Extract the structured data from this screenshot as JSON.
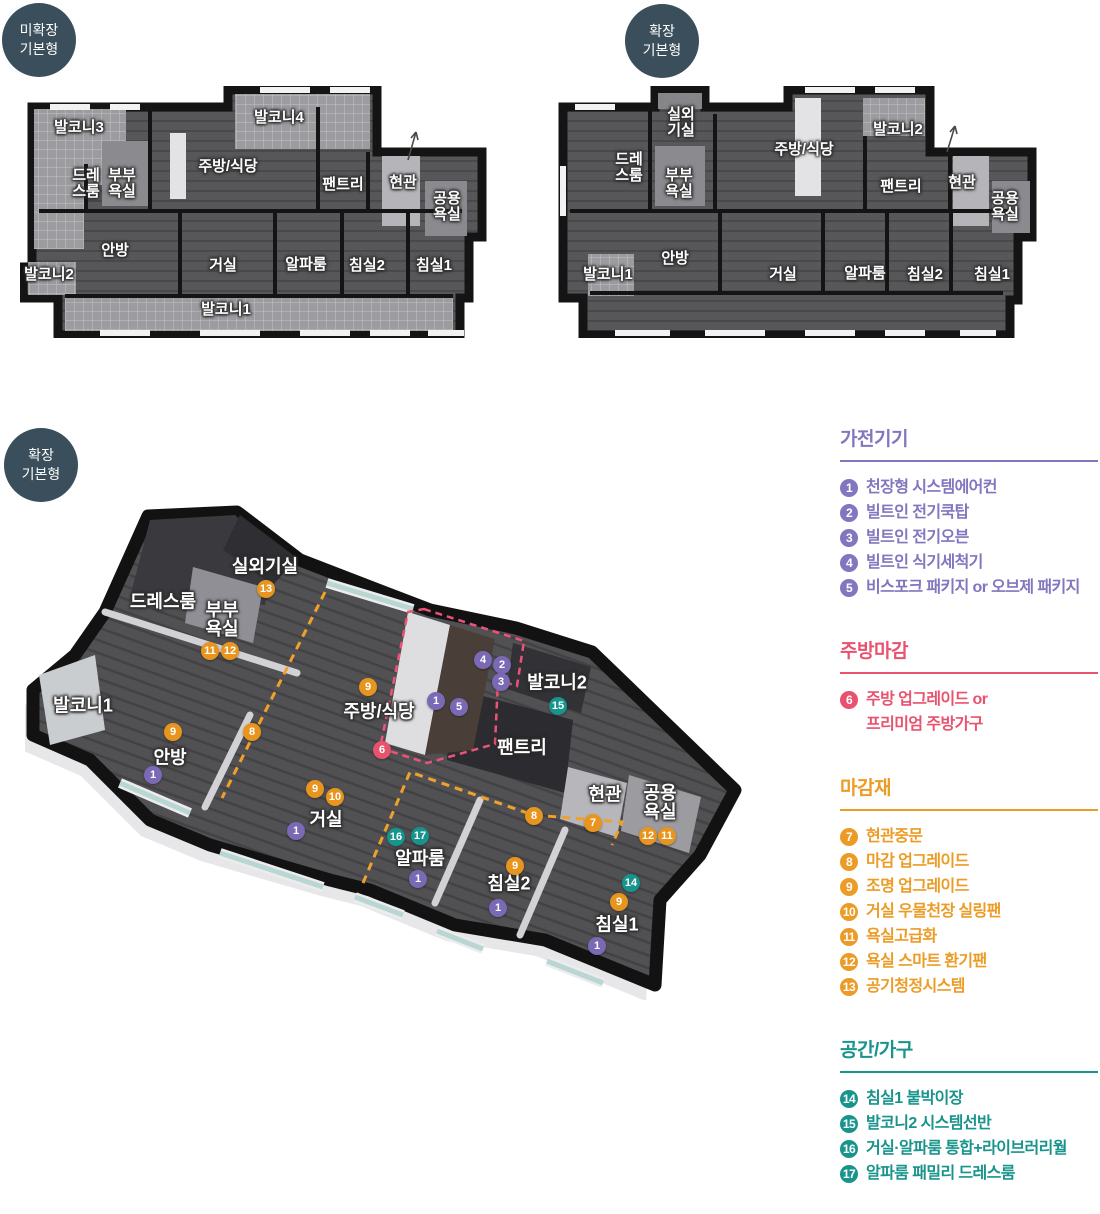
{
  "colors": {
    "purple": "#7a69b4",
    "pink": "#e5536e",
    "orange": "#e8951f",
    "teal": "#17948c",
    "badge_navy": "#3a4f5b"
  },
  "plan_a": {
    "badge_line1": "미확장",
    "badge_line2": "기본형",
    "rooms": [
      {
        "name": "발코니3",
        "x": 59,
        "y": 42
      },
      {
        "name": "발코니4",
        "x": 259,
        "y": 32
      },
      {
        "name": "주방/식당",
        "x": 208,
        "y": 81
      },
      {
        "name": "드레\n스룸",
        "x": 66,
        "y": 98
      },
      {
        "name": "부부\n욕실",
        "x": 102,
        "y": 98
      },
      {
        "name": "팬트리",
        "x": 323,
        "y": 99
      },
      {
        "name": "현관",
        "x": 383,
        "y": 97
      },
      {
        "name": "공용\n욕실",
        "x": 427,
        "y": 121
      },
      {
        "name": "안방",
        "x": 95,
        "y": 165
      },
      {
        "name": "거실",
        "x": 203,
        "y": 180
      },
      {
        "name": "알파룸",
        "x": 286,
        "y": 179
      },
      {
        "name": "침실2",
        "x": 347,
        "y": 180
      },
      {
        "name": "침실1",
        "x": 414,
        "y": 180
      },
      {
        "name": "발코니2",
        "x": 29,
        "y": 189
      },
      {
        "name": "발코니1",
        "x": 206,
        "y": 224
      }
    ]
  },
  "plan_b": {
    "badge_line1": "확장",
    "badge_line2": "기본형",
    "rooms": [
      {
        "name": "실외\n기실",
        "x": 126,
        "y": 37
      },
      {
        "name": "발코니2",
        "x": 343,
        "y": 44
      },
      {
        "name": "드레\n스룸",
        "x": 74,
        "y": 82
      },
      {
        "name": "부부\n욕실",
        "x": 124,
        "y": 98
      },
      {
        "name": "주방/식당",
        "x": 249,
        "y": 64
      },
      {
        "name": "팬트리",
        "x": 346,
        "y": 101
      },
      {
        "name": "현관",
        "x": 407,
        "y": 97
      },
      {
        "name": "공용\n욕실",
        "x": 450,
        "y": 121
      },
      {
        "name": "안방",
        "x": 120,
        "y": 173
      },
      {
        "name": "거실",
        "x": 228,
        "y": 189
      },
      {
        "name": "알파룸",
        "x": 310,
        "y": 188
      },
      {
        "name": "침실2",
        "x": 370,
        "y": 189
      },
      {
        "name": "침실1",
        "x": 437,
        "y": 189
      },
      {
        "name": "발코니1",
        "x": 53,
        "y": 189
      }
    ]
  },
  "plan_3d": {
    "badge_line1": "확장",
    "badge_line2": "기본형",
    "rooms": [
      {
        "name": "실외기실",
        "x": 240,
        "y": 62
      },
      {
        "name": "드레스룸",
        "x": 138,
        "y": 97
      },
      {
        "name": "부부\n욕실",
        "x": 197,
        "y": 115
      },
      {
        "name": "발코니1",
        "x": 58,
        "y": 201
      },
      {
        "name": "안방",
        "x": 145,
        "y": 253
      },
      {
        "name": "주방/식당",
        "x": 354,
        "y": 207
      },
      {
        "name": "발코니2",
        "x": 532,
        "y": 178
      },
      {
        "name": "팬트리",
        "x": 497,
        "y": 243
      },
      {
        "name": "현관",
        "x": 580,
        "y": 290
      },
      {
        "name": "공용\n욕실",
        "x": 635,
        "y": 298
      },
      {
        "name": "거실",
        "x": 301,
        "y": 315
      },
      {
        "name": "알파룸",
        "x": 395,
        "y": 354
      },
      {
        "name": "침실2",
        "x": 484,
        "y": 379
      },
      {
        "name": "침실1",
        "x": 592,
        "y": 420
      }
    ],
    "markers": [
      {
        "n": "13",
        "c": "orange",
        "x": 241,
        "y": 84
      },
      {
        "n": "11",
        "c": "orange",
        "x": 185,
        "y": 146
      },
      {
        "n": "12",
        "c": "orange",
        "x": 205,
        "y": 146
      },
      {
        "n": "9",
        "c": "orange",
        "x": 148,
        "y": 227
      },
      {
        "n": "1",
        "c": "purple",
        "x": 128,
        "y": 270
      },
      {
        "n": "8",
        "c": "orange",
        "x": 227,
        "y": 227
      },
      {
        "n": "9",
        "c": "orange",
        "x": 343,
        "y": 182
      },
      {
        "n": "1",
        "c": "purple",
        "x": 411,
        "y": 196
      },
      {
        "n": "5",
        "c": "purple",
        "x": 434,
        "y": 202
      },
      {
        "n": "6",
        "c": "pink",
        "x": 357,
        "y": 245
      },
      {
        "n": "4",
        "c": "purple",
        "x": 458,
        "y": 155
      },
      {
        "n": "2",
        "c": "purple",
        "x": 477,
        "y": 160
      },
      {
        "n": "3",
        "c": "purple",
        "x": 476,
        "y": 177
      },
      {
        "n": "15",
        "c": "teal",
        "x": 533,
        "y": 201
      },
      {
        "n": "9",
        "c": "orange",
        "x": 290,
        "y": 284
      },
      {
        "n": "10",
        "c": "orange",
        "x": 310,
        "y": 292
      },
      {
        "n": "1",
        "c": "purple",
        "x": 271,
        "y": 326
      },
      {
        "n": "16",
        "c": "teal",
        "x": 371,
        "y": 332
      },
      {
        "n": "17",
        "c": "teal",
        "x": 395,
        "y": 331
      },
      {
        "n": "1",
        "c": "purple",
        "x": 393,
        "y": 374
      },
      {
        "n": "9",
        "c": "orange",
        "x": 490,
        "y": 361
      },
      {
        "n": "1",
        "c": "purple",
        "x": 473,
        "y": 403
      },
      {
        "n": "14",
        "c": "teal",
        "x": 606,
        "y": 378
      },
      {
        "n": "9",
        "c": "orange",
        "x": 594,
        "y": 397
      },
      {
        "n": "1",
        "c": "purple",
        "x": 572,
        "y": 441
      },
      {
        "n": "7",
        "c": "orange",
        "x": 568,
        "y": 318
      },
      {
        "n": "8",
        "c": "orange",
        "x": 509,
        "y": 311
      },
      {
        "n": "12",
        "c": "orange",
        "x": 623,
        "y": 331
      },
      {
        "n": "11",
        "c": "orange",
        "x": 642,
        "y": 331
      }
    ]
  },
  "legend": {
    "sections": [
      {
        "title": "가전기기",
        "color": "#8176bf",
        "items": [
          {
            "n": "1",
            "label": "천장형 시스템에어컨"
          },
          {
            "n": "2",
            "label": "빌트인 전기쿡탑"
          },
          {
            "n": "3",
            "label": "빌트인 전기오븐"
          },
          {
            "n": "4",
            "label": "빌트인 식기세척기"
          },
          {
            "n": "5",
            "label": "비스포크 패키지 or 오브제 패키지"
          }
        ]
      },
      {
        "title": "주방마감",
        "color": "#e8526f",
        "items": [
          {
            "n": "6",
            "label": "주방 업그레이드 or\n프리미엄 주방가구"
          }
        ]
      },
      {
        "title": "마감재",
        "color": "#ec9c26",
        "items": [
          {
            "n": "7",
            "label": "현관중문"
          },
          {
            "n": "8",
            "label": "마감 업그레이드"
          },
          {
            "n": "9",
            "label": "조명 업그레이드"
          },
          {
            "n": "10",
            "label": "거실 우물천장 실링팬"
          },
          {
            "n": "11",
            "label": "욕실고급화"
          },
          {
            "n": "12",
            "label": "욕실 스마트 환기팬"
          },
          {
            "n": "13",
            "label": "공기청정시스템"
          }
        ]
      },
      {
        "title": "공간/가구",
        "color": "#18948c",
        "items": [
          {
            "n": "14",
            "label": "침실1 붙박이장"
          },
          {
            "n": "15",
            "label": "발코니2 시스템선반"
          },
          {
            "n": "16",
            "label": "거실·알파룸 통합+라이브러리월"
          },
          {
            "n": "17",
            "label": "알파룸 패밀리 드레스룸"
          }
        ]
      }
    ]
  }
}
